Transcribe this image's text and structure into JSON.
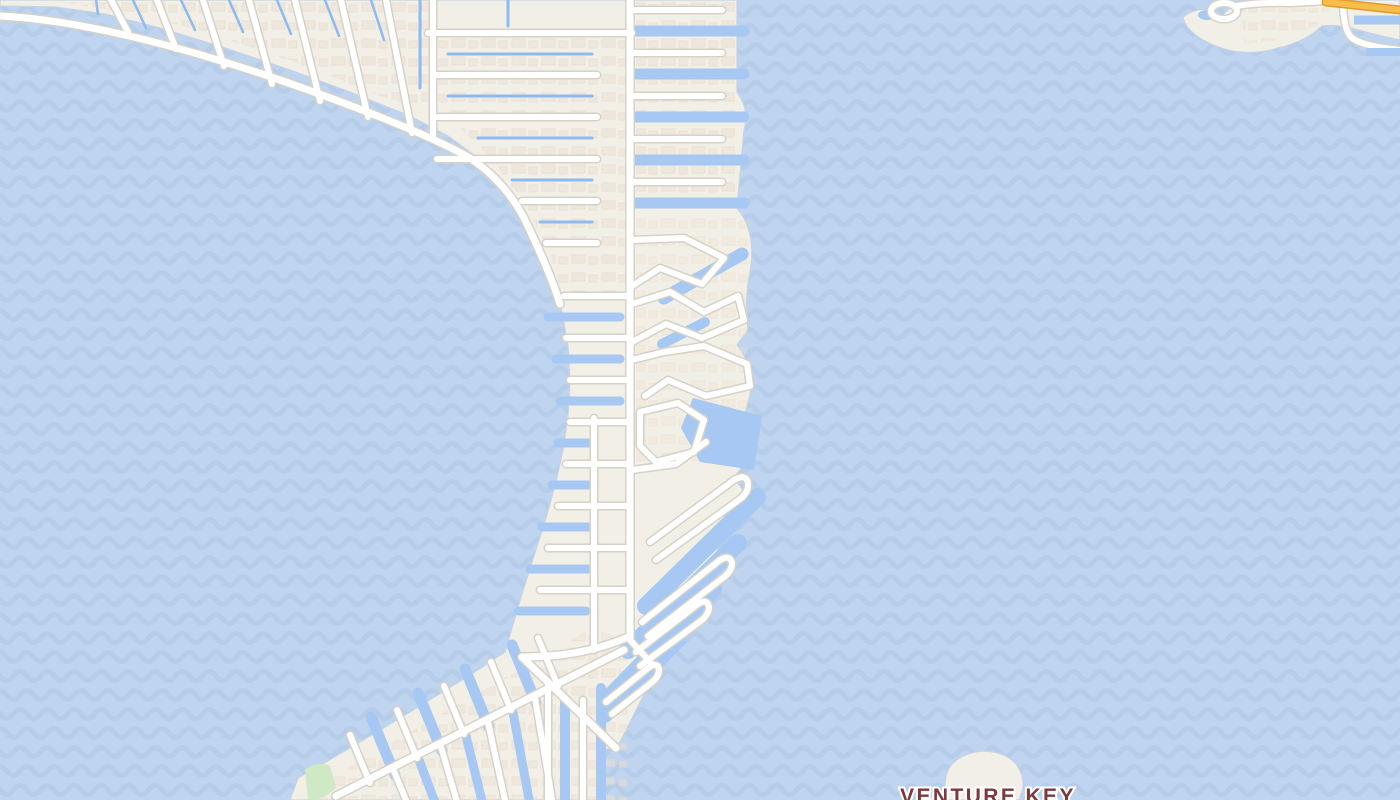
{
  "map": {
    "kind": "street-map",
    "place_labels": [
      {
        "text": "VENTURE KEY"
      }
    ],
    "palette": {
      "water": "#bfd4ee",
      "water_wave": "#b3cae8",
      "canal": "#a6c8f2",
      "canal_thin": "#8fbaf0",
      "land": "#f2efe6",
      "coast_edge": "#c6d3e6",
      "road_fill": "#ffffff",
      "road_casing": "#d6d2c8",
      "highway_fill": "#f8bc49",
      "highway_casing": "#e09a2d",
      "building_fill": "#ebe2d3",
      "building_edge": "#e5d0c4",
      "park": "#cfe9c4",
      "label_text": "#7d383c",
      "label_halo": "#ffffff"
    }
  }
}
